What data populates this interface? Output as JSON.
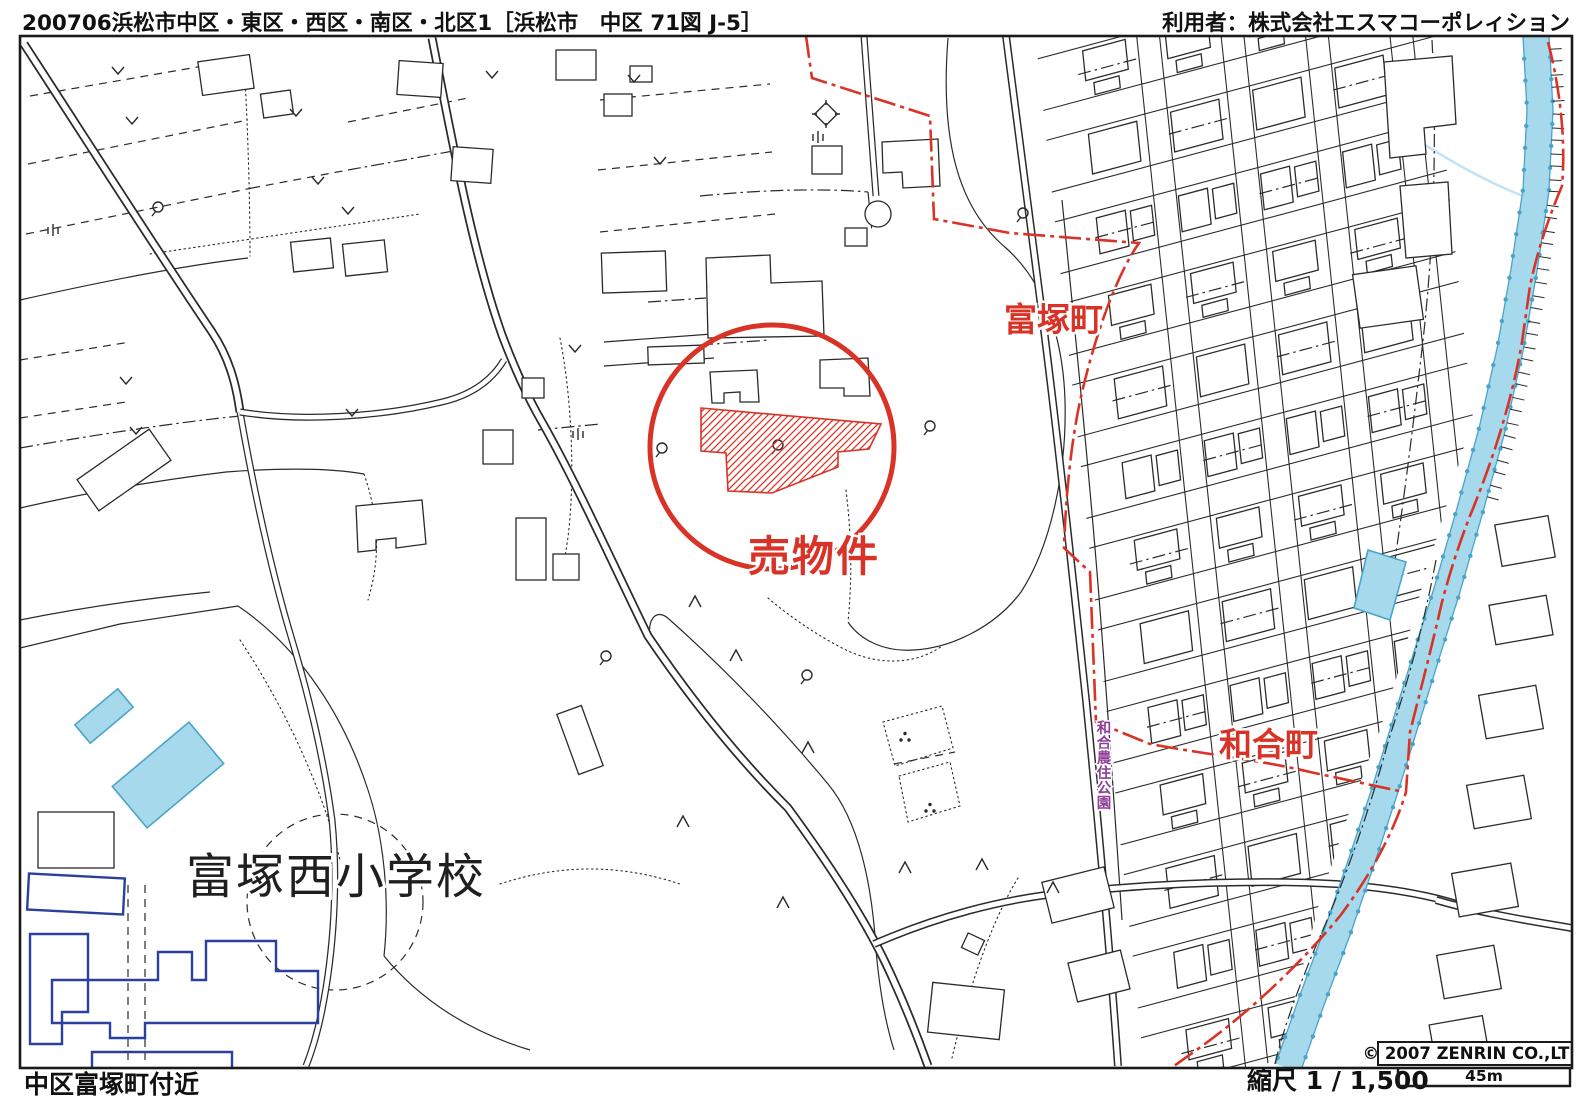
{
  "header": {
    "left_title": "200706浜松市中区・東区・西区・南区・北区1［浜松市　中区 71図 J-5］",
    "right_user": "利用者：株式会社エスマコーポレィション"
  },
  "map_labels": {
    "for_sale": "売物件",
    "district_north": "富塚町",
    "district_south": "和合町",
    "school": "富塚西小学校",
    "park": "和合農住公園"
  },
  "footer": {
    "area": "中区富塚町付近",
    "scale_label": "縮尺 1 / 1,500",
    "scale_distance": "45m",
    "copyright": "© 2007 ZENRIN CO.,LTD."
  },
  "colors": {
    "highlight": "#d93327",
    "water_fill": "#a7d9ec",
    "water_edge": "#4aa4c9",
    "school_blue": "#2a3f9e",
    "park_purple": "#8e3e96",
    "ink": "#2a2a2a"
  }
}
